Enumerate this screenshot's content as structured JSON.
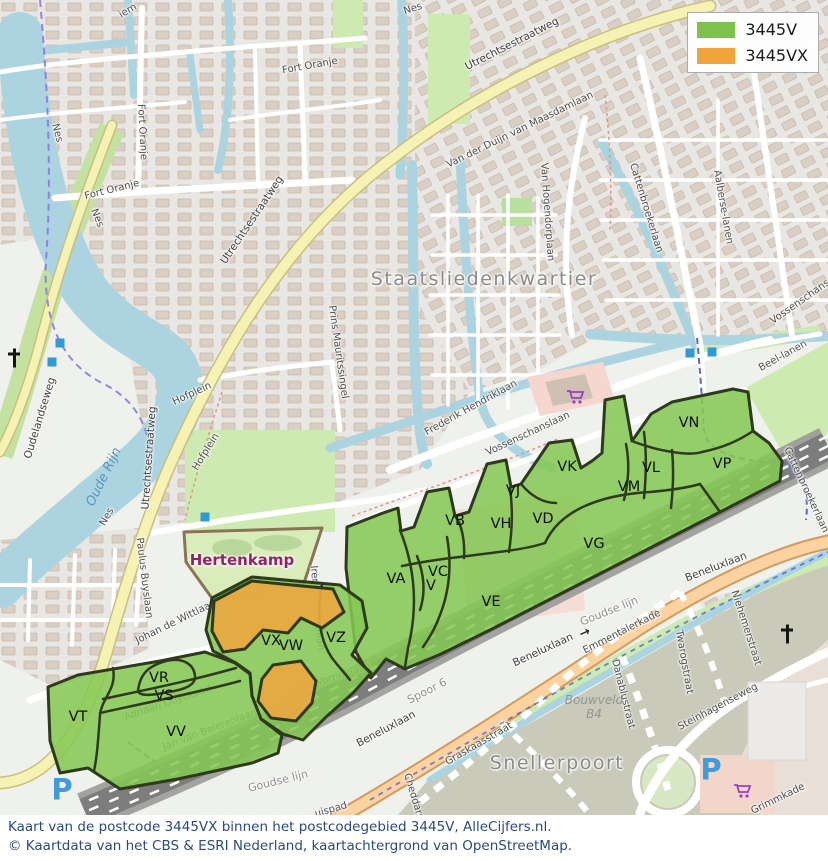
{
  "legend": {
    "items": [
      {
        "label": "3445V",
        "color": "#7fc24b"
      },
      {
        "label": "3445VX",
        "color": "#f2a43c"
      }
    ]
  },
  "caption": {
    "line1": "Kaart van de postcode 3445VX binnen het postcodegebied 3445V, AlleCijfers.nl.",
    "line2": "© Kaartdata van het CBS & ESRI Nederland, kaartachtergrond van OpenStreetMap."
  },
  "overlay": {
    "colors": {
      "green": "#85c854",
      "orange": "#eaa840",
      "border": "#2e3a1c"
    },
    "clusters": [
      {
        "name": "east-band",
        "points": "347,527 383,513 398,508 401,531 414,527 427,492 449,488 455,516 469,512 487,464 506,460 511,487 521,484 549,443 572,440 581,468 592,461 602,453 605,400 624,396 632,441 651,414 672,402 733,389 748,392 753,431 769,443 782,461 780,481 720,512 650,548 570,589 490,630 441,654 405,669 386,659 371,678 356,652 346,568"
      },
      {
        "name": "hertenkamp-zuid",
        "points": "212,598 252,577 340,585 362,601 367,628 352,655 371,673 353,693 327,716 303,740 283,734 261,719 252,696 250,673 236,663 213,651 206,630"
      },
      {
        "name": "zuidwest",
        "points": "48,687 78,675 160,661 205,652 235,663 250,674 252,696 261,719 282,735 278,753 252,763 178,779 120,789 88,768 60,773 50,741"
      }
    ],
    "orange_areas": [
      {
        "name": "3445vx-noord",
        "points": "214,601 252,581 333,589 344,612 322,628 301,618 288,633 263,630 245,649 223,652 212,631"
      },
      {
        "name": "3445vx-zuid",
        "points": "262,679 273,665 301,661 316,681 312,703 296,721 271,718 258,701"
      }
    ],
    "dividers": [
      "M400,530 C412,560 420,600 408,648 L405,667",
      "M447,537 C452,565 450,592 438,620 C433,633 427,641 423,647",
      "M417,556 C424,574 426,592 420,610",
      "M402,566 C440,558 472,556 506,551 C521,549 533,547 545,543",
      "M455,516 C462,524 465,542 464,558",
      "M510,488 C513,510 512,532 509,552",
      "M521,484 C532,497 544,503 556,503",
      "M545,543 C560,510 600,495 650,492 C672,490 690,487 700,484 L720,512",
      "M626,444 C630,464 628,484 624,500",
      "M644,432 C647,456 646,478 644,498",
      "M672,450 C674,470 673,490 671,508",
      "M632,441 C660,452 690,456 702,452 C722,448 740,440 753,431",
      "M322,584 C316,615 320,640 332,658 C338,666 344,672 350,680",
      "M113,668 C117,690 102,697 100,715 C98,742 97,757 94,771",
      "M103,699 C145,690 190,681 236,668",
      "M100,713 C145,703 196,693 240,681",
      "M138,691 C140,674 148,666 166,661 C184,657 194,665 195,676 C196,685 184,690 168,692 C154,695 140,697 138,691 Z"
    ],
    "codes": [
      {
        "code": "VA",
        "x": 396,
        "y": 579
      },
      {
        "code": "VB",
        "x": 455,
        "y": 521
      },
      {
        "code": "VC",
        "x": 438,
        "y": 572
      },
      {
        "code": "V",
        "x": 431,
        "y": 586
      },
      {
        "code": "VD",
        "x": 543,
        "y": 519
      },
      {
        "code": "VE",
        "x": 491,
        "y": 602
      },
      {
        "code": "VG",
        "x": 594,
        "y": 544
      },
      {
        "code": "VH",
        "x": 501,
        "y": 524
      },
      {
        "code": "VJ",
        "x": 513,
        "y": 491
      },
      {
        "code": "VK",
        "x": 567,
        "y": 467
      },
      {
        "code": "VL",
        "x": 651,
        "y": 468
      },
      {
        "code": "VM",
        "x": 629,
        "y": 487
      },
      {
        "code": "VN",
        "x": 689,
        "y": 423
      },
      {
        "code": "VP",
        "x": 722,
        "y": 464
      },
      {
        "code": "VR",
        "x": 159,
        "y": 678
      },
      {
        "code": "VS",
        "x": 164,
        "y": 696
      },
      {
        "code": "VT",
        "x": 78,
        "y": 717
      },
      {
        "code": "VV",
        "x": 176,
        "y": 732
      },
      {
        "code": "VW",
        "x": 291,
        "y": 646
      },
      {
        "code": "VX",
        "x": 271,
        "y": 641
      },
      {
        "code": "VZ",
        "x": 336,
        "y": 638
      }
    ]
  },
  "map_labels": [
    {
      "text": "Fort Oranje",
      "x": 310,
      "y": 66,
      "rot": -10,
      "cls": "street"
    },
    {
      "text": "Fort Oranje",
      "x": 142,
      "y": 132,
      "rot": 87,
      "cls": "street"
    },
    {
      "text": "Fort Oranje",
      "x": 112,
      "y": 190,
      "rot": -14,
      "cls": "street"
    },
    {
      "text": "Nes",
      "x": 57,
      "y": 133,
      "rot": 75,
      "cls": "street"
    },
    {
      "text": "Nes",
      "x": 97,
      "y": 218,
      "rot": 68,
      "cls": "street"
    },
    {
      "text": "Nes",
      "x": 413,
      "y": 9,
      "rot": -18,
      "cls": "street"
    },
    {
      "text": "Nes",
      "x": 107,
      "y": 517,
      "rot": -60,
      "cls": "street"
    },
    {
      "text": "iem",
      "x": 128,
      "y": 11,
      "rot": -30,
      "cls": "street"
    },
    {
      "text": "Utrechtsestraatweg",
      "x": 512,
      "y": 44,
      "rot": -27,
      "cls": "road-on"
    },
    {
      "text": "Utrechtsestraatweg",
      "x": 252,
      "y": 220,
      "rot": -56,
      "cls": "road-on"
    },
    {
      "text": "Utrechtsestraatweg",
      "x": 149,
      "y": 458,
      "rot": -86,
      "cls": "road-on"
    },
    {
      "text": "Van der Duijn van Maasdamlaan",
      "x": 520,
      "y": 130,
      "rot": -26,
      "cls": "street"
    },
    {
      "text": "Van Hogendorplaan",
      "x": 547,
      "y": 212,
      "rot": 86,
      "cls": "street"
    },
    {
      "text": "Staatsliedenkwartier",
      "x": 484,
      "y": 279,
      "rot": 0,
      "cls": "place-lg"
    },
    {
      "text": "Prins Mauritssingel",
      "x": 338,
      "y": 352,
      "rot": 82,
      "cls": "street"
    },
    {
      "text": "Frederik Hendriklaan",
      "x": 471,
      "y": 408,
      "rot": -29,
      "cls": "street"
    },
    {
      "text": "Vossenschanslaan",
      "x": 528,
      "y": 434,
      "rot": -25,
      "cls": "street"
    },
    {
      "text": "Vossenschans",
      "x": 800,
      "y": 302,
      "rot": -35,
      "cls": "street"
    },
    {
      "text": "Beel-lanen",
      "x": 783,
      "y": 356,
      "rot": -29,
      "cls": "street"
    },
    {
      "text": "Cattenbroekerlaan",
      "x": 646,
      "y": 208,
      "rot": 73,
      "cls": "street"
    },
    {
      "text": "Cattenbroekerlaan",
      "x": 806,
      "y": 490,
      "rot": 65,
      "cls": "street"
    },
    {
      "text": "Aalberse-lanen",
      "x": 723,
      "y": 207,
      "rot": 80,
      "cls": "street"
    },
    {
      "text": "Hofplein",
      "x": 192,
      "y": 394,
      "rot": -25,
      "cls": "street"
    },
    {
      "text": "Hofplein",
      "x": 206,
      "y": 452,
      "rot": -58,
      "cls": "street"
    },
    {
      "text": "Oudelandseweg",
      "x": 40,
      "y": 418,
      "rot": -73,
      "cls": "road-on"
    },
    {
      "text": "Oude Rijn",
      "x": 104,
      "y": 477,
      "rot": -64,
      "cls": "water"
    },
    {
      "text": "Paulus Buyslaan",
      "x": 144,
      "y": 578,
      "rot": 83,
      "cls": "street"
    },
    {
      "text": "Hertenkamp",
      "x": 242,
      "y": 560,
      "rot": 0,
      "cls": "park-name"
    },
    {
      "text": "Johan de Wittlaan",
      "x": 176,
      "y": 622,
      "rot": -26,
      "cls": "street"
    },
    {
      "text": "Adriaan Duyckpad",
      "x": 168,
      "y": 703,
      "rot": -19,
      "cls": "street"
    },
    {
      "text": "Jan van Beierenlaan",
      "x": 210,
      "y": 730,
      "rot": -21,
      "cls": "street"
    },
    {
      "text": "Irene Vorrinklaan",
      "x": 317,
      "y": 608,
      "rot": 85,
      "cls": "street"
    },
    {
      "text": "Irene Vorrinklaan",
      "x": 330,
      "y": 679,
      "rot": -18,
      "cls": "street"
    },
    {
      "text": "Beneluxlaan",
      "x": 543,
      "y": 650,
      "rot": -25,
      "cls": "road-on"
    },
    {
      "text": "→",
      "x": 585,
      "y": 633,
      "rot": -25,
      "cls": "arrow"
    },
    {
      "text": "Beneluxlaan",
      "x": 386,
      "y": 729,
      "rot": -28,
      "cls": "road-on"
    },
    {
      "text": "Beneluxlaan",
      "x": 716,
      "y": 567,
      "rot": -21,
      "cls": "road-on"
    },
    {
      "text": "Spoor 6",
      "x": 427,
      "y": 691,
      "rot": -27,
      "cls": "rail"
    },
    {
      "text": "Goudse lijn",
      "x": 609,
      "y": 611,
      "rot": -22,
      "cls": "rail"
    },
    {
      "text": "Goudse lijn",
      "x": 278,
      "y": 781,
      "rot": -14,
      "cls": "rail"
    },
    {
      "text": "Emmentalerkade",
      "x": 622,
      "y": 632,
      "rot": -27,
      "cls": "street"
    },
    {
      "text": "Danablustraat",
      "x": 623,
      "y": 694,
      "rot": 76,
      "cls": "street"
    },
    {
      "text": "Bouwveld",
      "x": 594,
      "y": 700,
      "rot": 0,
      "cls": "constr"
    },
    {
      "text": "B4",
      "x": 594,
      "y": 714,
      "rot": 0,
      "cls": "constr"
    },
    {
      "text": "Graskaasstraat",
      "x": 479,
      "y": 744,
      "rot": -30,
      "cls": "street"
    },
    {
      "text": "Snellerpoort",
      "x": 557,
      "y": 763,
      "rot": 0,
      "cls": "place-lg"
    },
    {
      "text": "Cheddarstraat",
      "x": 417,
      "y": 808,
      "rot": 73,
      "cls": "street"
    },
    {
      "text": "Twarogstraat",
      "x": 684,
      "y": 662,
      "rot": 80,
      "cls": "street"
    },
    {
      "text": "Niehemerstraat",
      "x": 746,
      "y": 628,
      "rot": 72,
      "cls": "street"
    },
    {
      "text": "Steinhagenseweg",
      "x": 718,
      "y": 707,
      "rot": -28,
      "cls": "street"
    },
    {
      "text": "Grimmkade",
      "x": 778,
      "y": 799,
      "rot": -26,
      "cls": "street"
    },
    {
      "text": "uispad",
      "x": 331,
      "y": 810,
      "rot": -16,
      "cls": "street"
    }
  ],
  "markers": {
    "bus_squares": [
      [
        60,
        343
      ],
      [
        52,
        362
      ],
      [
        205,
        517
      ],
      [
        690,
        353
      ],
      [
        712,
        352
      ]
    ],
    "church_crosses": [
      [
        14,
        358
      ],
      [
        787,
        634
      ]
    ],
    "parking": [
      [
        62,
        790
      ],
      [
        711,
        770
      ]
    ],
    "supermarket_carts": [
      [
        566,
        389
      ],
      [
        733,
        783
      ]
    ]
  }
}
